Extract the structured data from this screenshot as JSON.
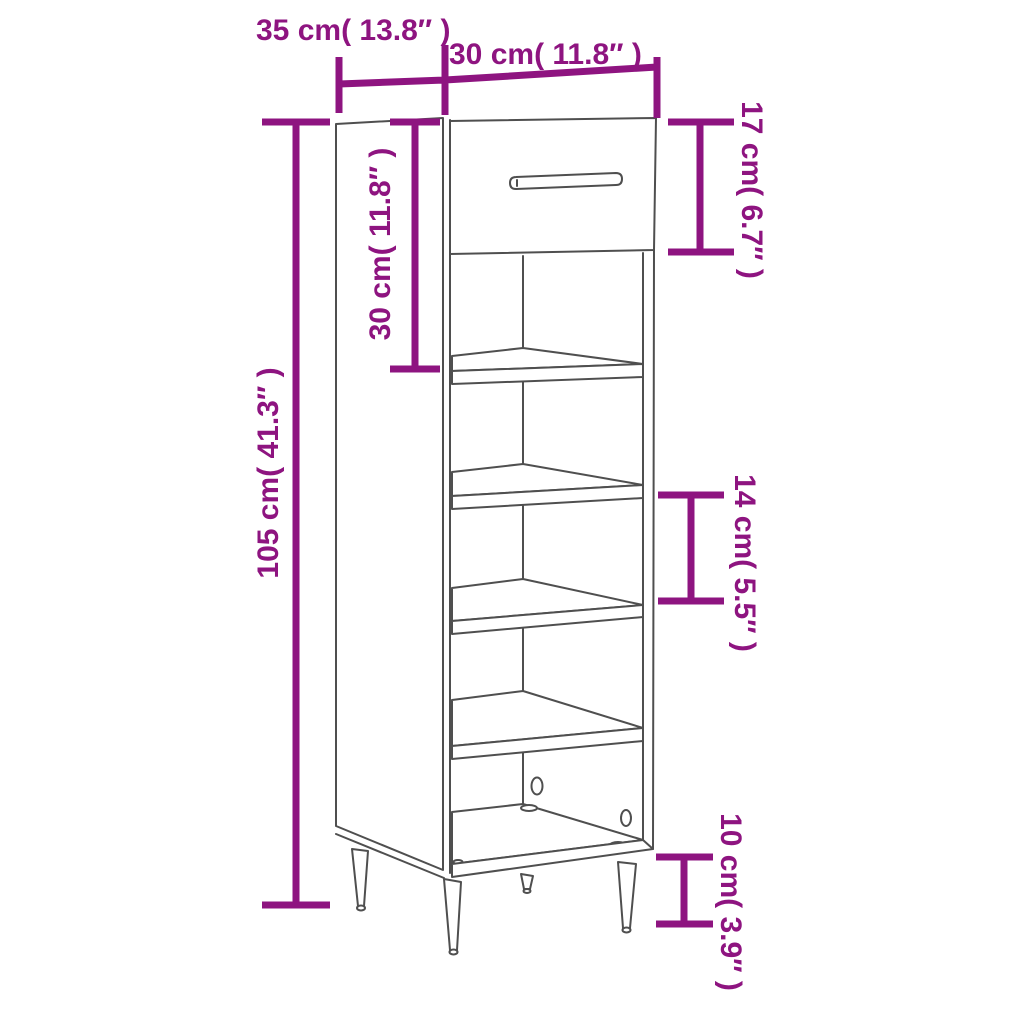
{
  "colors": {
    "dimension_accent": "#8E1480",
    "line_art": "#4f4f4f",
    "background": "#ffffff"
  },
  "diagram": {
    "type": "product-dimension-diagram",
    "subject": "narrow shoe cabinet with top drawer, four open shelves and tapered legs",
    "dimensions": [
      {
        "id": "depth",
        "label": "35 cm( 13.8″ )",
        "cm": 35,
        "inches": 13.8,
        "measures": "cabinet depth (top left)"
      },
      {
        "id": "width",
        "label": "30 cm( 11.8″ )",
        "cm": 30,
        "inches": 11.8,
        "measures": "cabinet width (top right)"
      },
      {
        "id": "upper_section",
        "label": "30 cm( 11.8″ )",
        "cm": 30,
        "inches": 11.8,
        "measures": "height of drawer section"
      },
      {
        "id": "drawer_front",
        "label": "17 cm( 6.7″ )",
        "cm": 17,
        "inches": 6.7,
        "measures": "drawer front height"
      },
      {
        "id": "total_height",
        "label": "105 cm( 41.3″ )",
        "cm": 105,
        "inches": 41.3,
        "measures": "total cabinet height"
      },
      {
        "id": "shelf_spacing",
        "label": "14 cm( 5.5″ )",
        "cm": 14,
        "inches": 5.5,
        "measures": "shelf compartment height"
      },
      {
        "id": "leg_height",
        "label": "10 cm( 3.9″ )",
        "cm": 10,
        "inches": 3.9,
        "measures": "leg height"
      }
    ]
  }
}
